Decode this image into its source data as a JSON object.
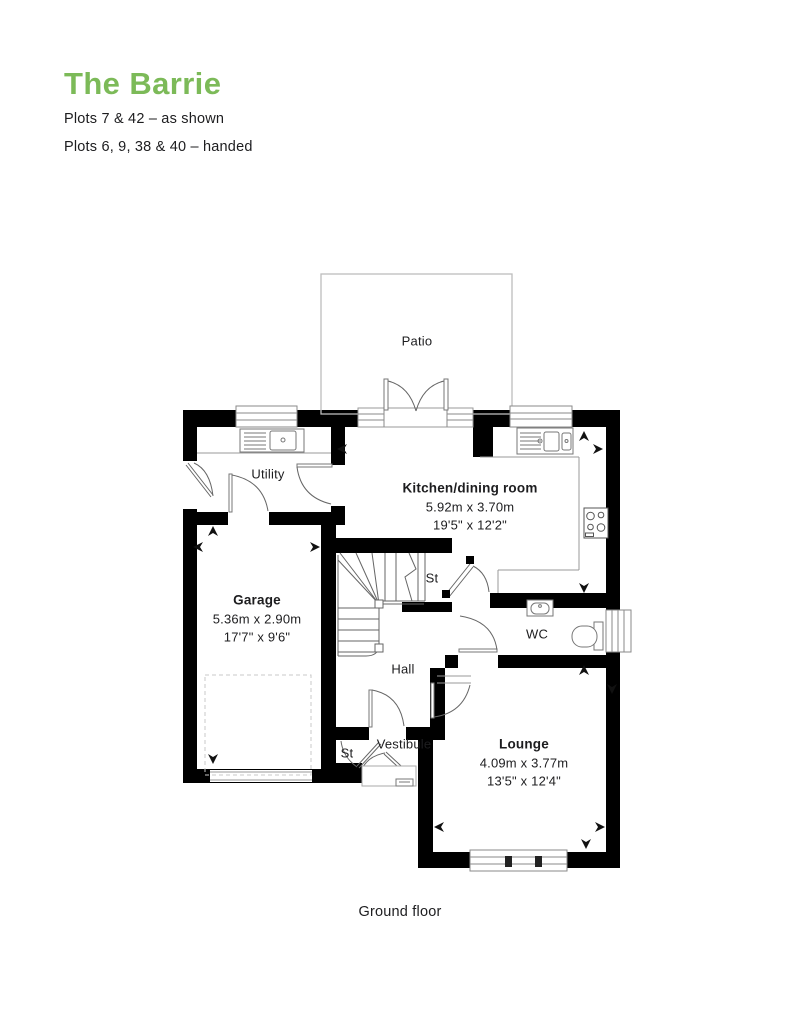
{
  "colors": {
    "accent": "#7cba58",
    "wall": "#000000",
    "text": "#1d1d1f",
    "window_gray": "#8a8a8a",
    "patio_border": "#bdbdbd"
  },
  "header": {
    "title": "The Barrie",
    "line1": "Plots 7 & 42 – as shown",
    "line2": "Plots 6, 9, 38 & 40 – handed"
  },
  "plan": {
    "patio": "Patio",
    "utility": "Utility",
    "kitchen": {
      "name": "Kitchen/dining room",
      "metric": "5.92m x 3.70m",
      "imperial": "19'5\" x 12'2\""
    },
    "garage": {
      "name": "Garage",
      "metric": "5.36m x 2.90m",
      "imperial": "17'7\" x 9'6\""
    },
    "lounge": {
      "name": "Lounge",
      "metric": "4.09m x 3.77m",
      "imperial": "13'5\" x 12'4\""
    },
    "wc": "WC",
    "hall": "Hall",
    "vestibule": "Vestibule",
    "st_upper": "St",
    "st_lower": "St",
    "floor": "Ground floor"
  }
}
